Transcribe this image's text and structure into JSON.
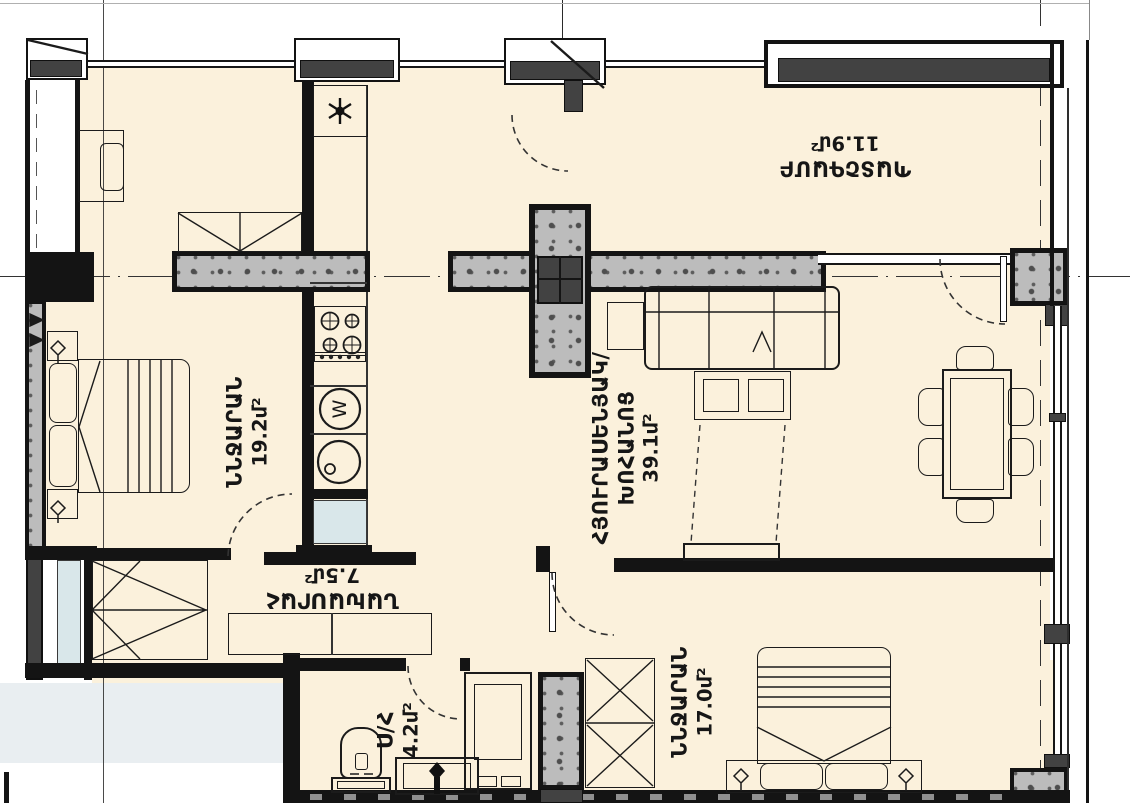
{
  "rooms": {
    "bedroom1": {
      "name": "ՆՆՋԱՐԱՆ",
      "area": "19.2մ²"
    },
    "living_kitchen": {
      "name_line1": "ՀՅՈՒՐԱՍԵՆՅԱԿ/",
      "name_line2": "ԽՈՀԱՆՈՑ",
      "area": "39.1մ²"
    },
    "bedroom2": {
      "name": "ՆՆՋԱՐԱՆ",
      "area": "17.0մ²"
    },
    "bathroom": {
      "name": "Ս/Հ",
      "area": "4.2մ²"
    },
    "hallway": {
      "name": "ՆԱԽԱՍՐԱՀ",
      "area": "7.5մ²"
    },
    "balcony": {
      "name": "ՊԱՏՇԳԱՄԲ",
      "area": "11.9մ²"
    }
  },
  "appliances": {
    "washer_letter": "W"
  },
  "icons": {
    "fridge": "snowflake-icon",
    "washer": "washing-machine-icon"
  },
  "colors": {
    "floor": "#fbf1dc",
    "wall": "#141414",
    "concrete": "#bcbcbc",
    "frame_dark": "#424242",
    "glass": "#d9e7ea",
    "outside": "#e9eef1"
  }
}
